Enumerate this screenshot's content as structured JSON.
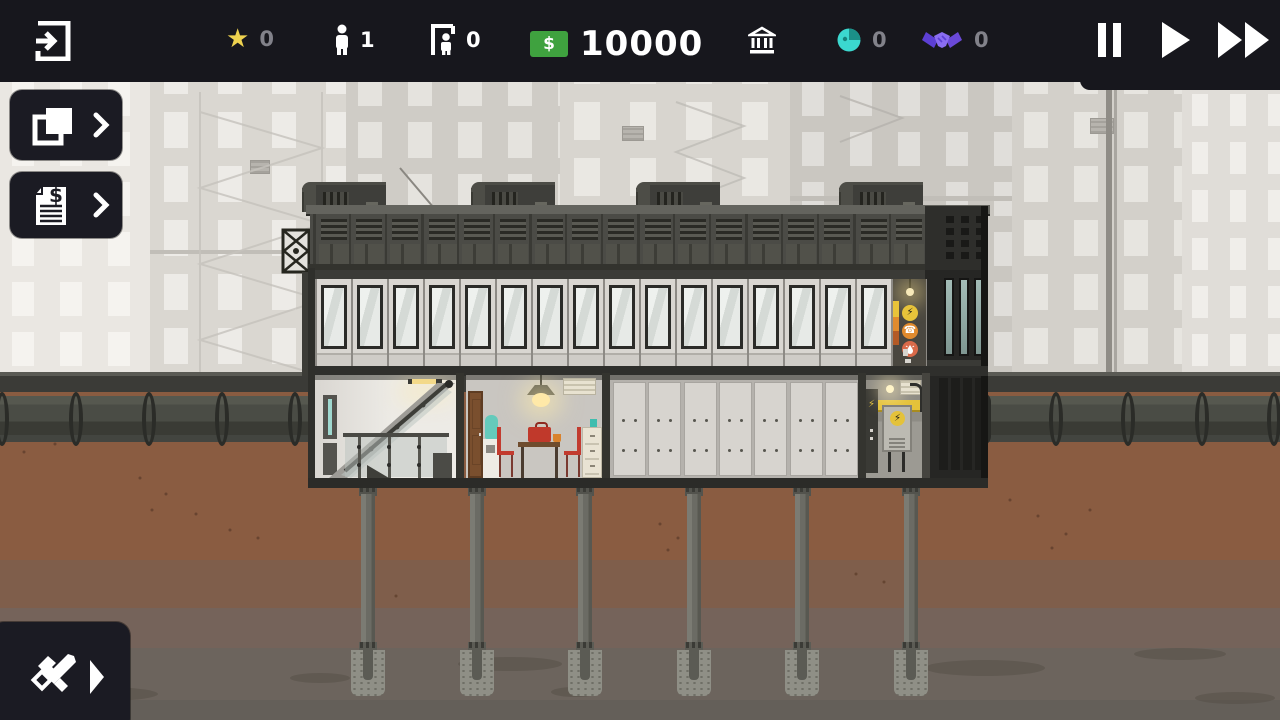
{
  "topbar": {
    "prestige": "0",
    "population": "1",
    "workers": "0",
    "money": "10000",
    "currency": "$",
    "influence": "0",
    "contracts": "0",
    "time": "10:01"
  },
  "scene": {
    "colors": {
      "money_green": "#3fa23f",
      "star_yellow": "#eed24f",
      "influence_cyan": "#3bd8cf",
      "contract_purple": "#8a6df2",
      "hazard_yellow": "#e4c23a",
      "topbar_dark": "#17171d"
    },
    "window_count": 16,
    "roof_panel_count": 17,
    "ground_panel_count": 7,
    "pillar_xs": [
      368,
      477,
      585,
      694,
      802,
      911
    ],
    "hvac_xs": [
      316,
      485,
      650,
      853
    ],
    "pipe_ring_xs_left": [
      2,
      76,
      149,
      222,
      295
    ],
    "pipe_ring_xs_right": [
      1056,
      1128,
      1202,
      1274
    ],
    "tower_slot_xs": [
      944,
      959,
      974
    ],
    "utility_icons": [
      "power",
      "phone",
      "water"
    ]
  }
}
